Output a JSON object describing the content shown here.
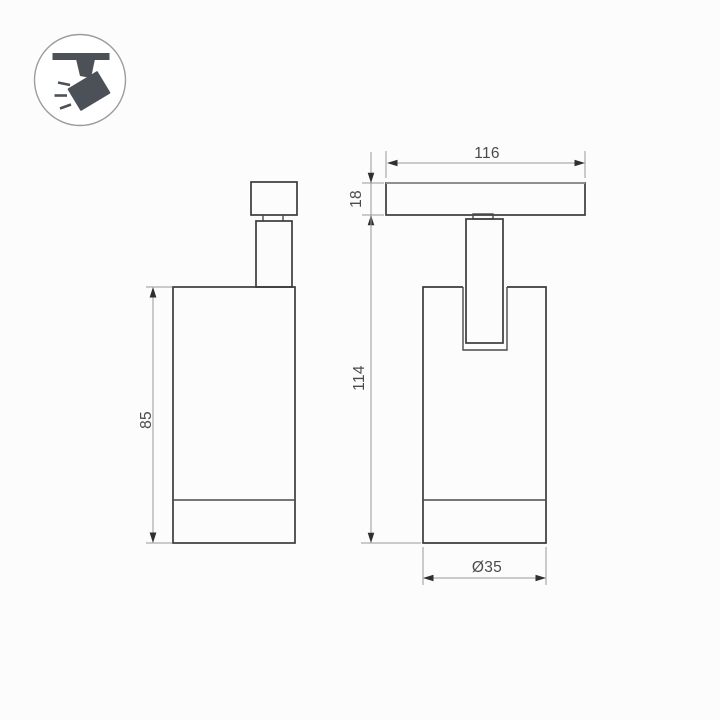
{
  "drawing": {
    "icon": "ceiling-track-spotlight-icon",
    "views": {
      "left": "side-view",
      "right": "front-view"
    },
    "dimensions": {
      "track_width": "116",
      "track_height": "18",
      "overall_height": "114",
      "body_height": "85",
      "body_diameter": "Ø35"
    }
  },
  "colors": {
    "background": "#fcfcfc",
    "outline": "#3b3b3b",
    "dimension_line": "#979797",
    "arrow": "#2f2f2f",
    "dimension_text": "#4a4a4a",
    "icon": "#4b5157",
    "icon_circle": "#9c9c9c"
  }
}
